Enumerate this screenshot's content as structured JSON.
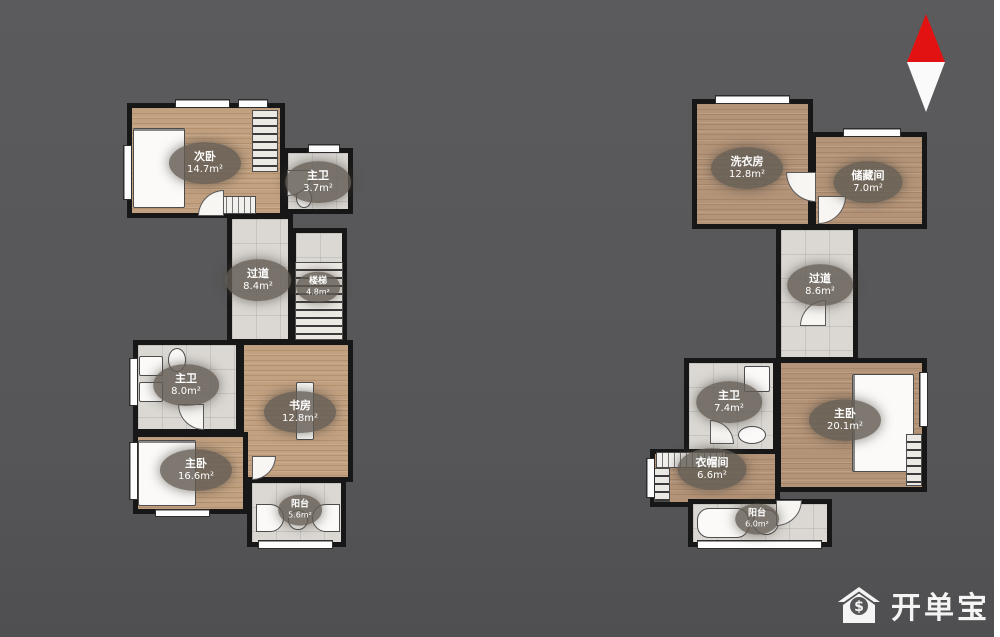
{
  "scene": {
    "background": "#565658"
  },
  "compass": {
    "top_color": "#e31212",
    "bottom_color": "#fafafa"
  },
  "watermark": {
    "text": "开单宝",
    "icon": "house-dollar-icon"
  },
  "plans": [
    {
      "id": "left-plan",
      "rooms": [
        {
          "name": "次卧",
          "area": "14.7m²"
        },
        {
          "name": "主卫",
          "area": "3.7m²"
        },
        {
          "name": "过道",
          "area": "8.4m²"
        },
        {
          "name": "楼梯",
          "area": "4.8m²"
        },
        {
          "name": "主卫",
          "area": "8.0m²"
        },
        {
          "name": "书房",
          "area": "12.8m²"
        },
        {
          "name": "主卧",
          "area": "16.6m²"
        },
        {
          "name": "阳台",
          "area": "5.6m²"
        }
      ]
    },
    {
      "id": "right-plan",
      "rooms": [
        {
          "name": "洗衣房",
          "area": "12.8m²"
        },
        {
          "name": "储藏间",
          "area": "7.0m²"
        },
        {
          "name": "过道",
          "area": "8.6m²"
        },
        {
          "name": "主卫",
          "area": "7.4m²"
        },
        {
          "name": "主卧",
          "area": "20.1m²"
        },
        {
          "name": "衣帽间",
          "area": "6.6m²"
        },
        {
          "name": "阳台",
          "area": "6.0m²"
        }
      ]
    }
  ]
}
